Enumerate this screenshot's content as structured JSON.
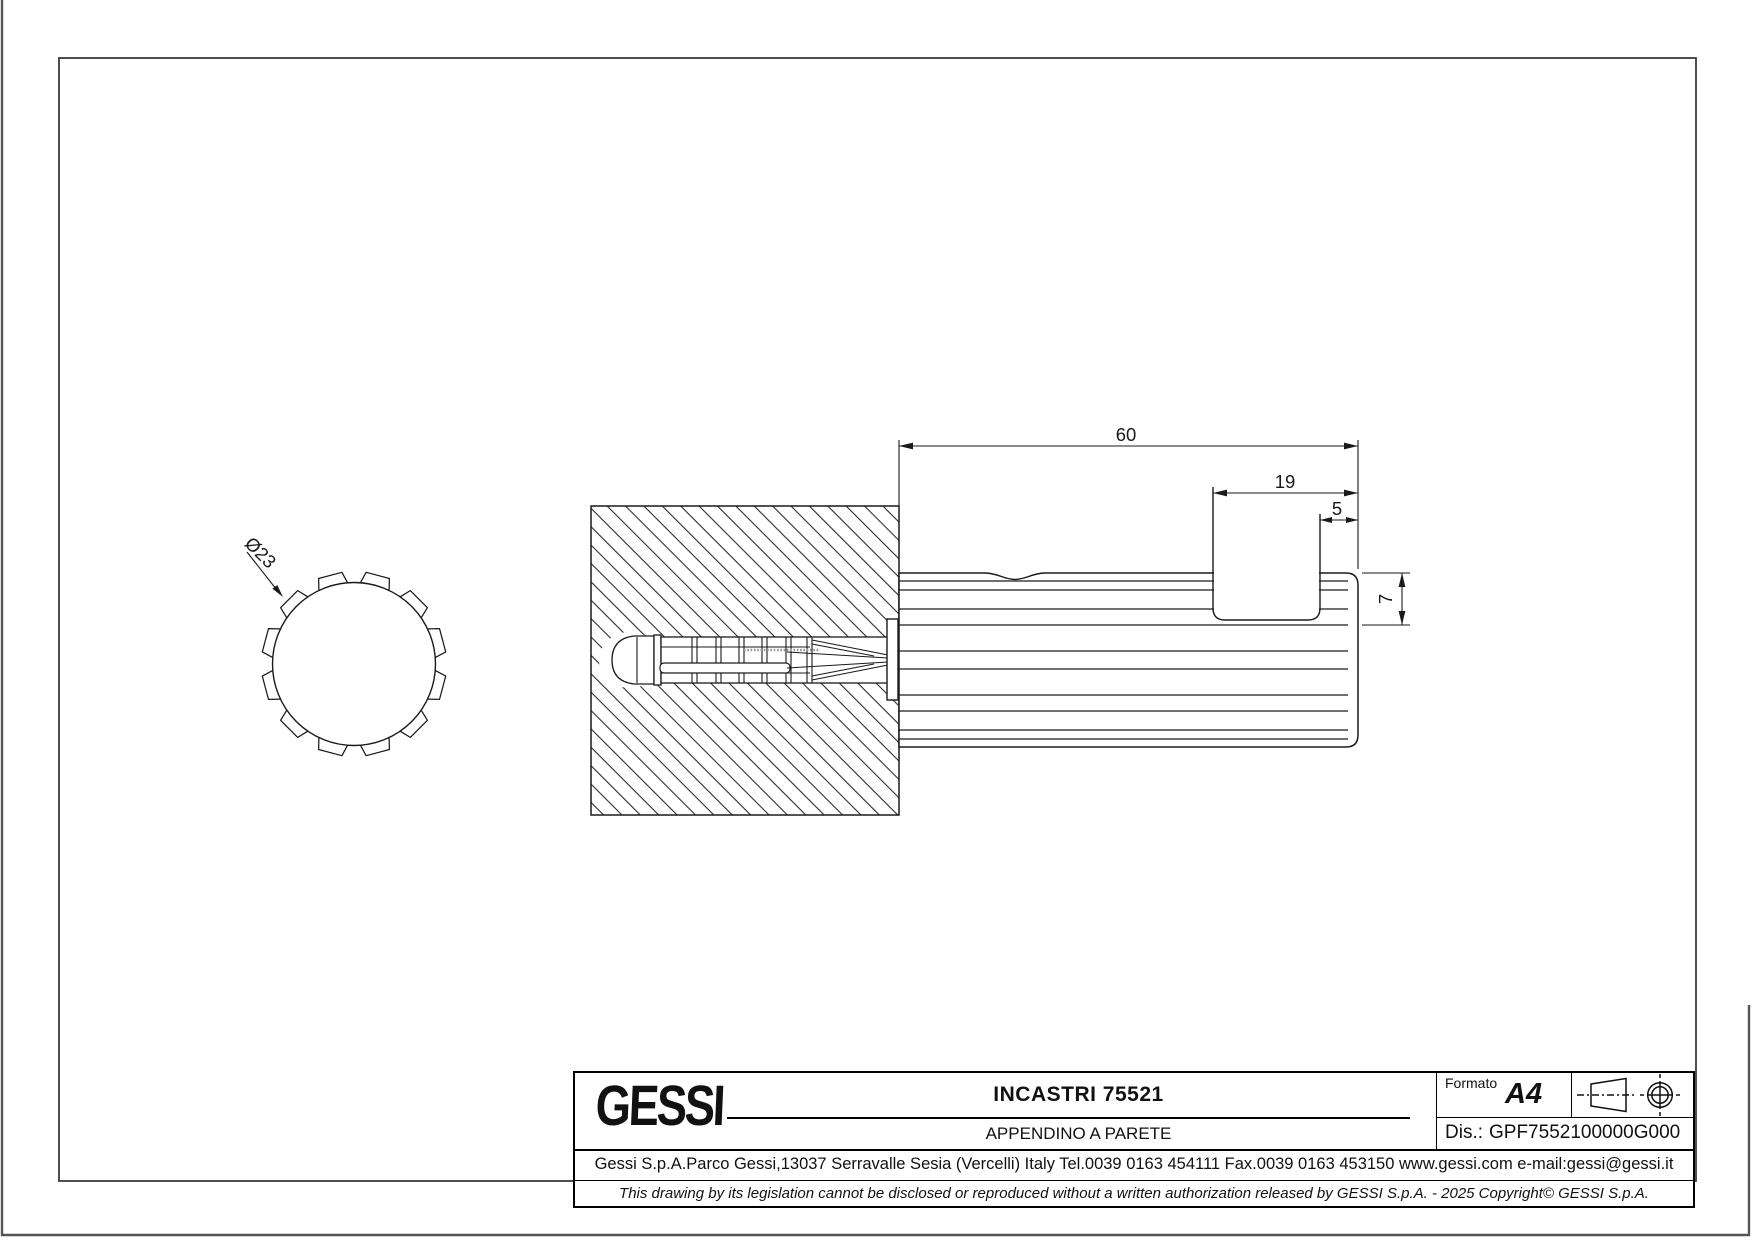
{
  "page": {
    "background": "#ffffff",
    "line_color": "#1a1a1a"
  },
  "views": {
    "front": {
      "diameter_label": "Ø23"
    },
    "side": {
      "dim_length": "60",
      "dim_slot_width": "19",
      "dim_slot_offset": "5",
      "dim_rim_height": "7"
    }
  },
  "title_block": {
    "logo_text": "GESSI",
    "title": "INCASTRI 75521",
    "subtitle": "APPENDINO A PARETE",
    "format_label": "Formato",
    "format_value": "A4",
    "drawing_no_label": "Dis.:",
    "drawing_no_value": "GPF7552100000G000",
    "address_line": "Gessi S.p.A.Parco Gessi,13037 Serravalle Sesia (Vercelli) Italy Tel.0039 0163 454111 Fax.0039 0163 453150 www.gessi.com e-mail:gessi@gessi.it",
    "legal_line": "This drawing by its legislation cannot be disclosed or reproduced without a written authorization released by GESSI S.p.A. - 2025 Copyright© GESSI S.p.A."
  }
}
